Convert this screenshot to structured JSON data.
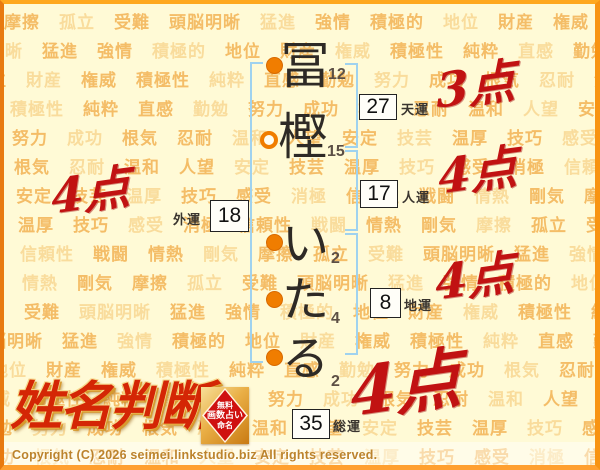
{
  "page": {
    "title": "姓名判断 結果"
  },
  "background": {
    "base_color": "#fffad6",
    "word_color": "#f2b254",
    "words": [
      "摩擦",
      "孤立",
      "受難",
      "頭脳明晰",
      "猛進",
      "強情",
      "積極的",
      "地位",
      "財産",
      "権威",
      "積極性",
      "純粋",
      "直感",
      "勤勉",
      "努力",
      "成功",
      "根気",
      "忍耐",
      "温和",
      "人望",
      "安定",
      "技芸",
      "温厚",
      "技巧",
      "感受",
      "消極",
      "信頼性",
      "戦闘",
      "情熱",
      "剛気"
    ]
  },
  "name": {
    "full": "冨樫いたる",
    "chars": [
      {
        "char": "冨",
        "strokes": "12",
        "marker": "filled"
      },
      {
        "char": "樫",
        "strokes": "15",
        "marker": "hollow"
      },
      {
        "char": "い",
        "strokes": "2",
        "marker": "filled"
      },
      {
        "char": "た",
        "strokes": "4",
        "marker": "filled"
      },
      {
        "char": "る",
        "strokes": "2",
        "marker": "filled"
      }
    ]
  },
  "fortunes": {
    "tenun": {
      "value": "27",
      "label": "天運",
      "score": "3点"
    },
    "jinun": {
      "value": "17",
      "label": "人運",
      "score": "4点"
    },
    "chiun": {
      "value": "8",
      "label": "地運",
      "score": "4点"
    },
    "gaiun": {
      "value": "18",
      "label": "外運",
      "score": "4点"
    },
    "soun": {
      "value": "35",
      "label": "総運",
      "score": "4点"
    }
  },
  "colors": {
    "score_red": "#c11212",
    "bracket_blue": "#9fd2ef",
    "marker_orange": "#f07d00",
    "border_orange": "#ffa81e"
  },
  "logo": {
    "text": "姓名判断"
  },
  "seal": {
    "lines": [
      "無料",
      "画数占い",
      "命名"
    ]
  },
  "footer": {
    "copyright": "Copyright (C) 2026 seimei.linkstudio.biz All rights reserved."
  }
}
